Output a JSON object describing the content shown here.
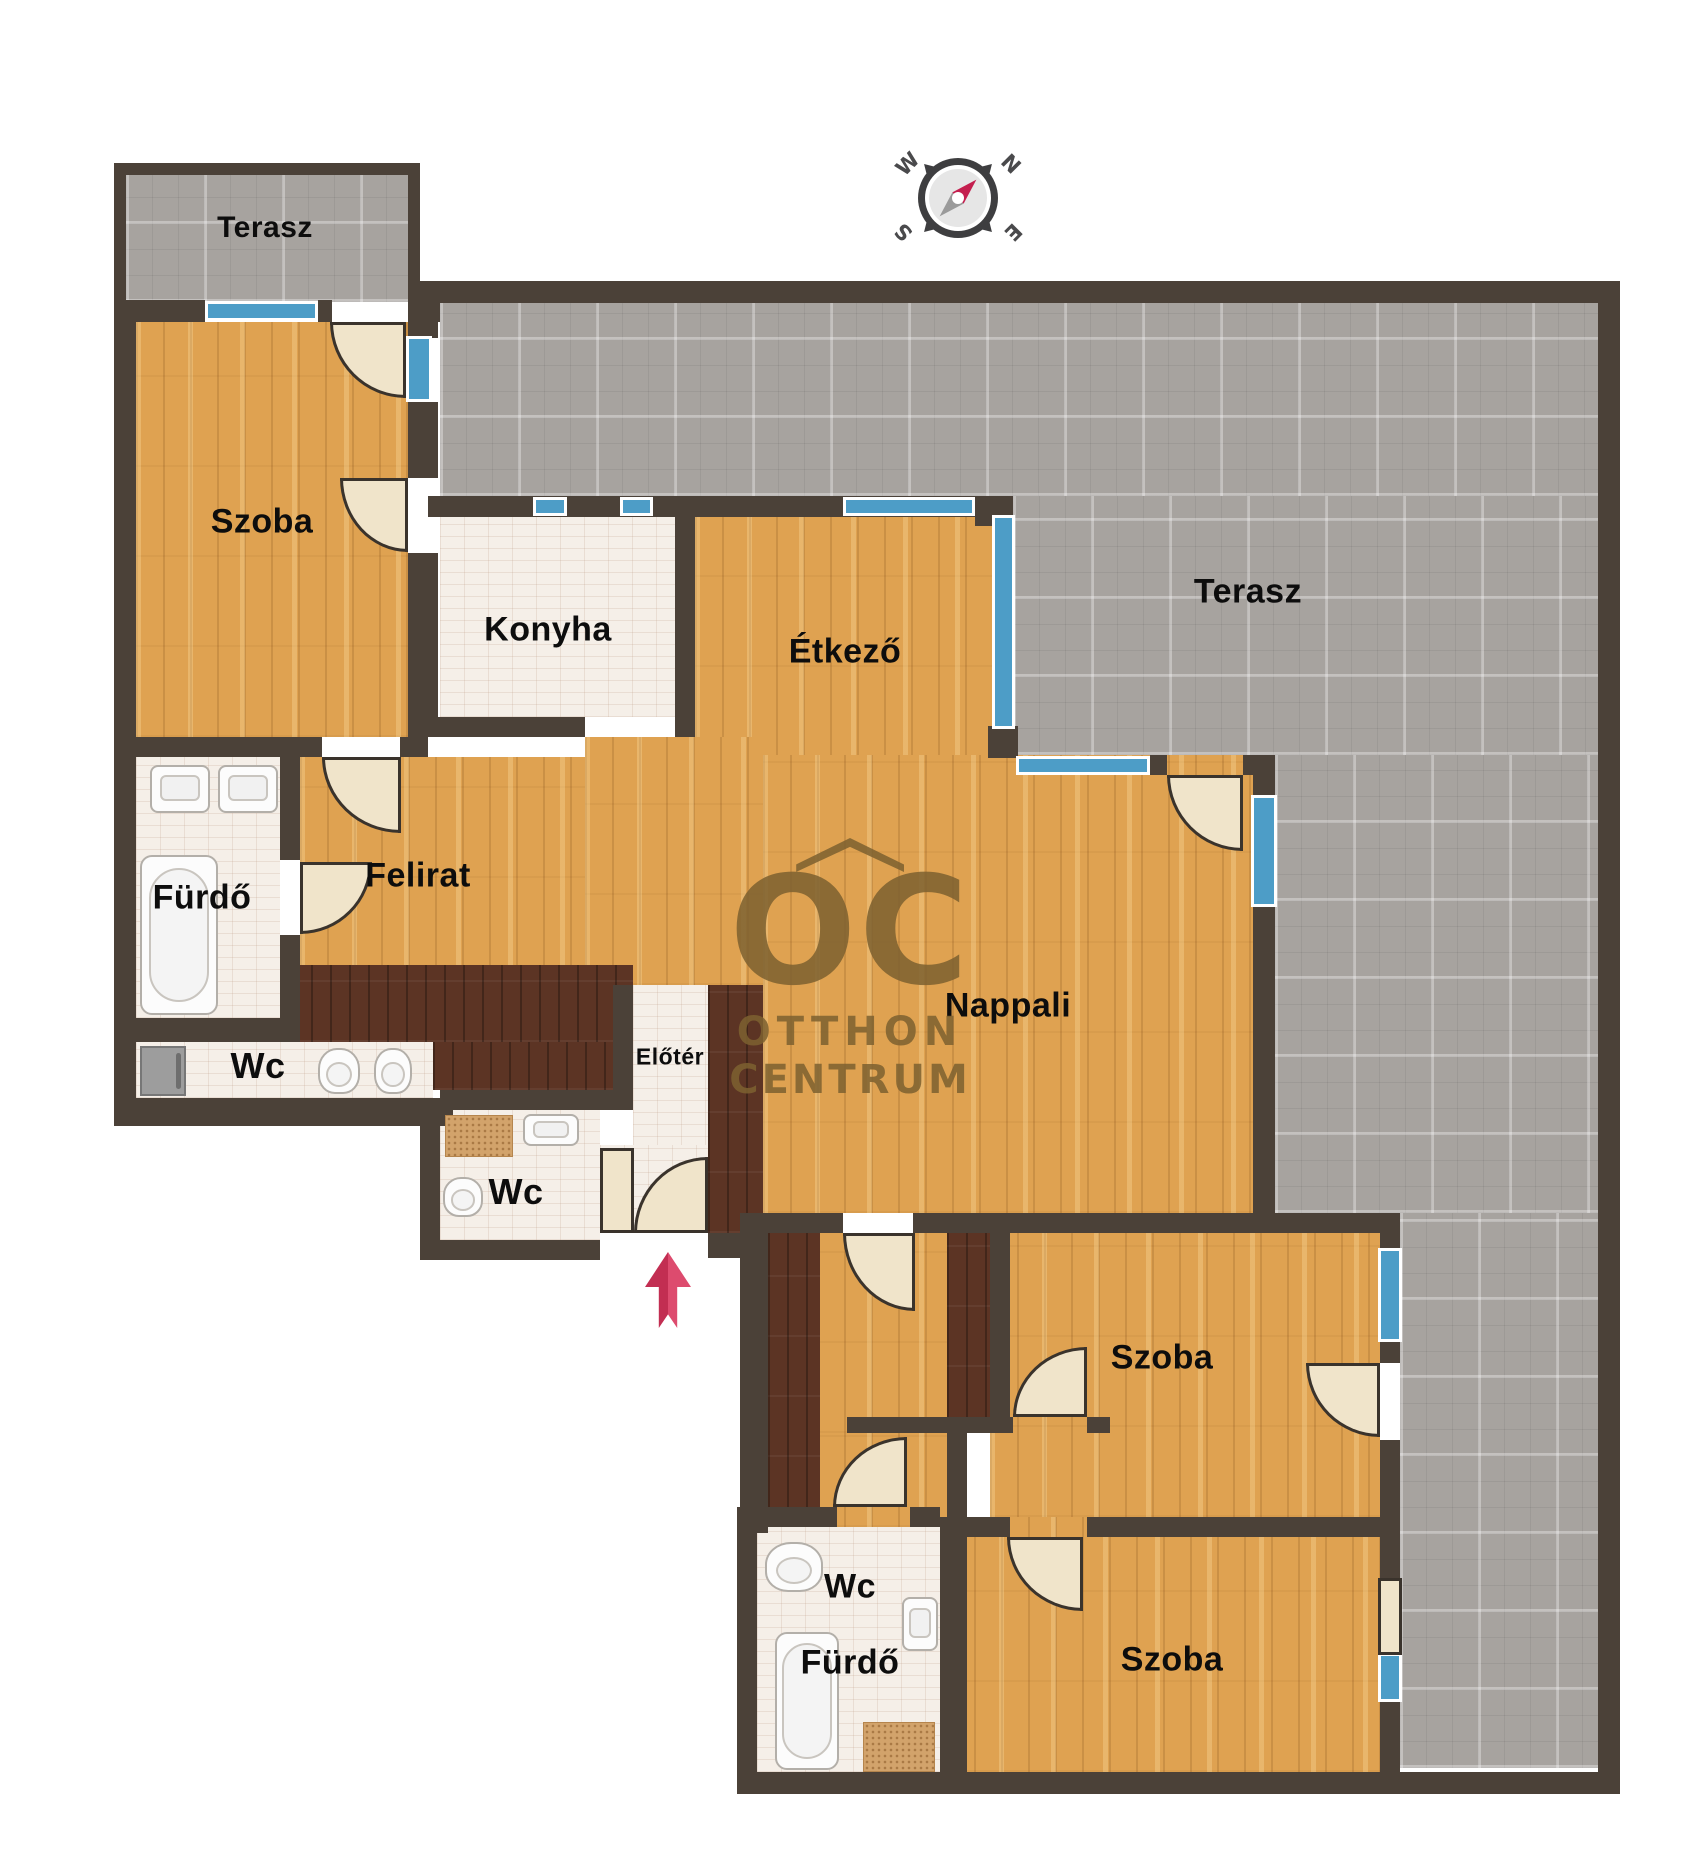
{
  "rooms": {
    "terrace_top": "Terasz",
    "terrace_right": "Terasz",
    "bedroom_topleft": "Szoba",
    "kitchen": "Konyha",
    "dining": "Étkező",
    "bathroom_left": "Fürdő",
    "hall": "Felirat",
    "wc_left": "Wc",
    "foyer": "Előtér",
    "wc_middle": "Wc",
    "living": "Nappali",
    "bedroom_middle": "Szoba",
    "wc_bottom": "Wc",
    "bathroom_bottom": "Fürdő",
    "bedroom_bottom": "Szoba"
  },
  "logo": {
    "letters": "OC",
    "line1": "OTTHON",
    "line2": "CENTRUM"
  },
  "compass": {
    "n": "N",
    "e": "E",
    "s": "S",
    "w": "W"
  },
  "theme": {
    "wall": "#4b4138",
    "wood": "#dfa251",
    "darkwood": "#5c3424",
    "tile": "#f5efe8",
    "terrace": "#a7a39f",
    "window": "#4d9dc7",
    "doorleaf": "#f0e4ca",
    "logo": "#7d6130",
    "arrow": "#d23b5f"
  }
}
